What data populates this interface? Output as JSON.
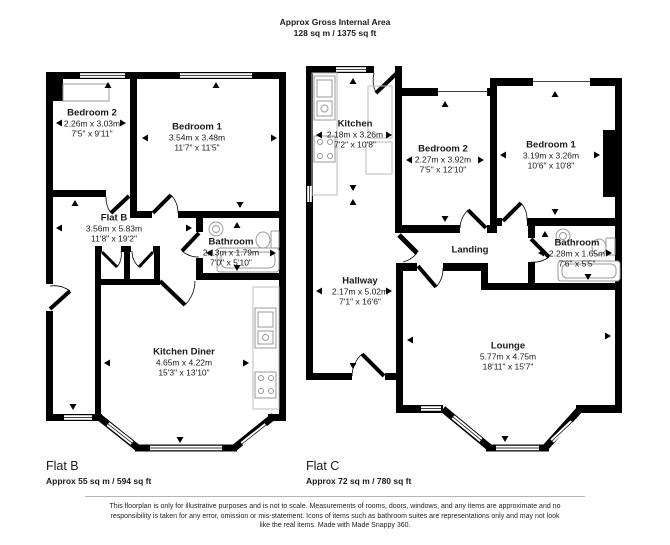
{
  "header": {
    "line1": "Approx Gross Internal Area",
    "line2": "128 sq m / 1375 sq ft"
  },
  "flat_b": {
    "name": "Flat B",
    "area": "Approx 55 sq m / 594 sq ft",
    "rooms": {
      "bedroom2": {
        "name": "Bedroom 2",
        "metric": "2.26m x 3.03m",
        "imperial": "7'5\" x 9'11\""
      },
      "bedroom1": {
        "name": "Bedroom 1",
        "metric": "3.54m x 3.48m",
        "imperial": "11'7\" x 11'5\""
      },
      "hall": {
        "name": "Flat B",
        "metric": "3.56m x 5.83m",
        "imperial": "11'8\" x 19'2\""
      },
      "bathroom": {
        "name": "Bathroom",
        "metric": "2.13m x 1.79m",
        "imperial": "7'0\" x 5'10\""
      },
      "kitchen_diner": {
        "name": "Kitchen Diner",
        "metric": "4.65m x 4.22m",
        "imperial": "15'3\" x 13'10\""
      }
    }
  },
  "flat_c": {
    "name": "Flat C",
    "area": "Approx 72 sq m / 780 sq ft",
    "rooms": {
      "kitchen": {
        "name": "Kitchen",
        "metric": "2.18m x 3.26m",
        "imperial": "7'2\" x 10'8\""
      },
      "bedroom2": {
        "name": "Bedroom 2",
        "metric": "2.27m x 3.92m",
        "imperial": "7'5\" x 12'10\""
      },
      "bedroom1": {
        "name": "Bedroom 1",
        "metric": "3.19m x 3.26m",
        "imperial": "10'6\" x 10'8\""
      },
      "landing": {
        "name": "Landing"
      },
      "bathroom": {
        "name": "Bathroom",
        "metric": "2.28m x 1.65m",
        "imperial": "7'6\" x 5'5\""
      },
      "hallway": {
        "name": "Hallway",
        "metric": "2.17m x 5.02m",
        "imperial": "7'1\" x 16'6\""
      },
      "lounge": {
        "name": "Lounge",
        "metric": "5.77m x 4.75m",
        "imperial": "18'11\" x 15'7\""
      }
    }
  },
  "icons": {
    "measurement_arrow": "small black triangle",
    "bath_icon": "rounded rectangle tub outline",
    "toilet_icon": "cistern and bowl outline",
    "sink_icon": "round basin outline",
    "stove_icon": "four burner rings outline",
    "window_icon": "double-line glazing in wall",
    "door_icon": "leaf with quarter-circle swing arc"
  },
  "colors": {
    "wall": "#000000",
    "fixture": "#999999",
    "counter": "#bbbbbb",
    "divider_line": "#b5b5b5"
  },
  "disclaimer": "This floorplan is only for illustrative purposes and is not to scale. Measurements of rooms, doors, windows, and any items are approximate and no responsibility is taken for any error, omission or mis-statement. Icons of items such as bathroom suites are representations only and may not look like the real items. Made with Made Snappy 360."
}
